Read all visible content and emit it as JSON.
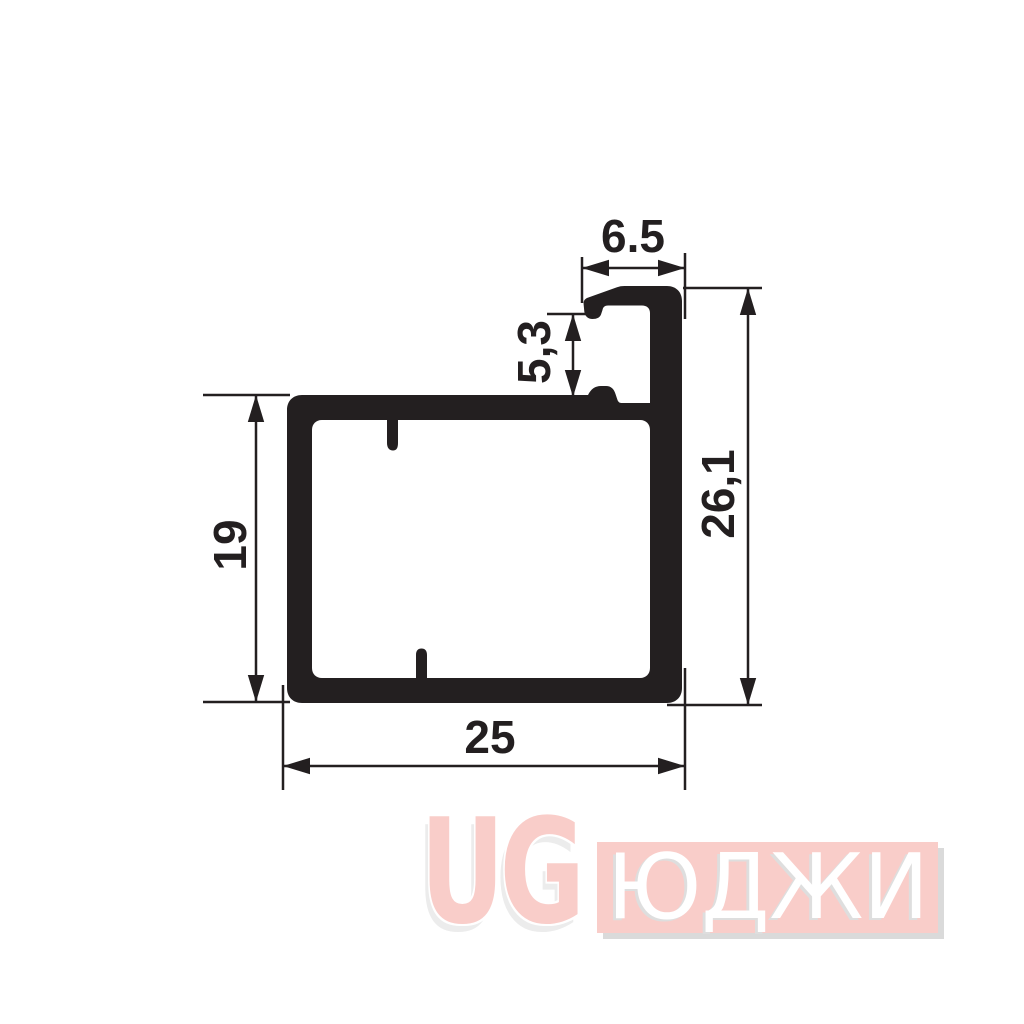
{
  "drawing": {
    "ink_color": "#231f20",
    "dimensions": {
      "flange_width": "6.5",
      "slot_gap": "5,3",
      "inner_height": "19",
      "overall_height": "26,1",
      "overall_width": "25"
    }
  },
  "watermark": {
    "logo_text": "UG",
    "brand_text": "ЮДЖИ",
    "pink": "#f9cdc9",
    "shadow_gray": "#dadada"
  }
}
